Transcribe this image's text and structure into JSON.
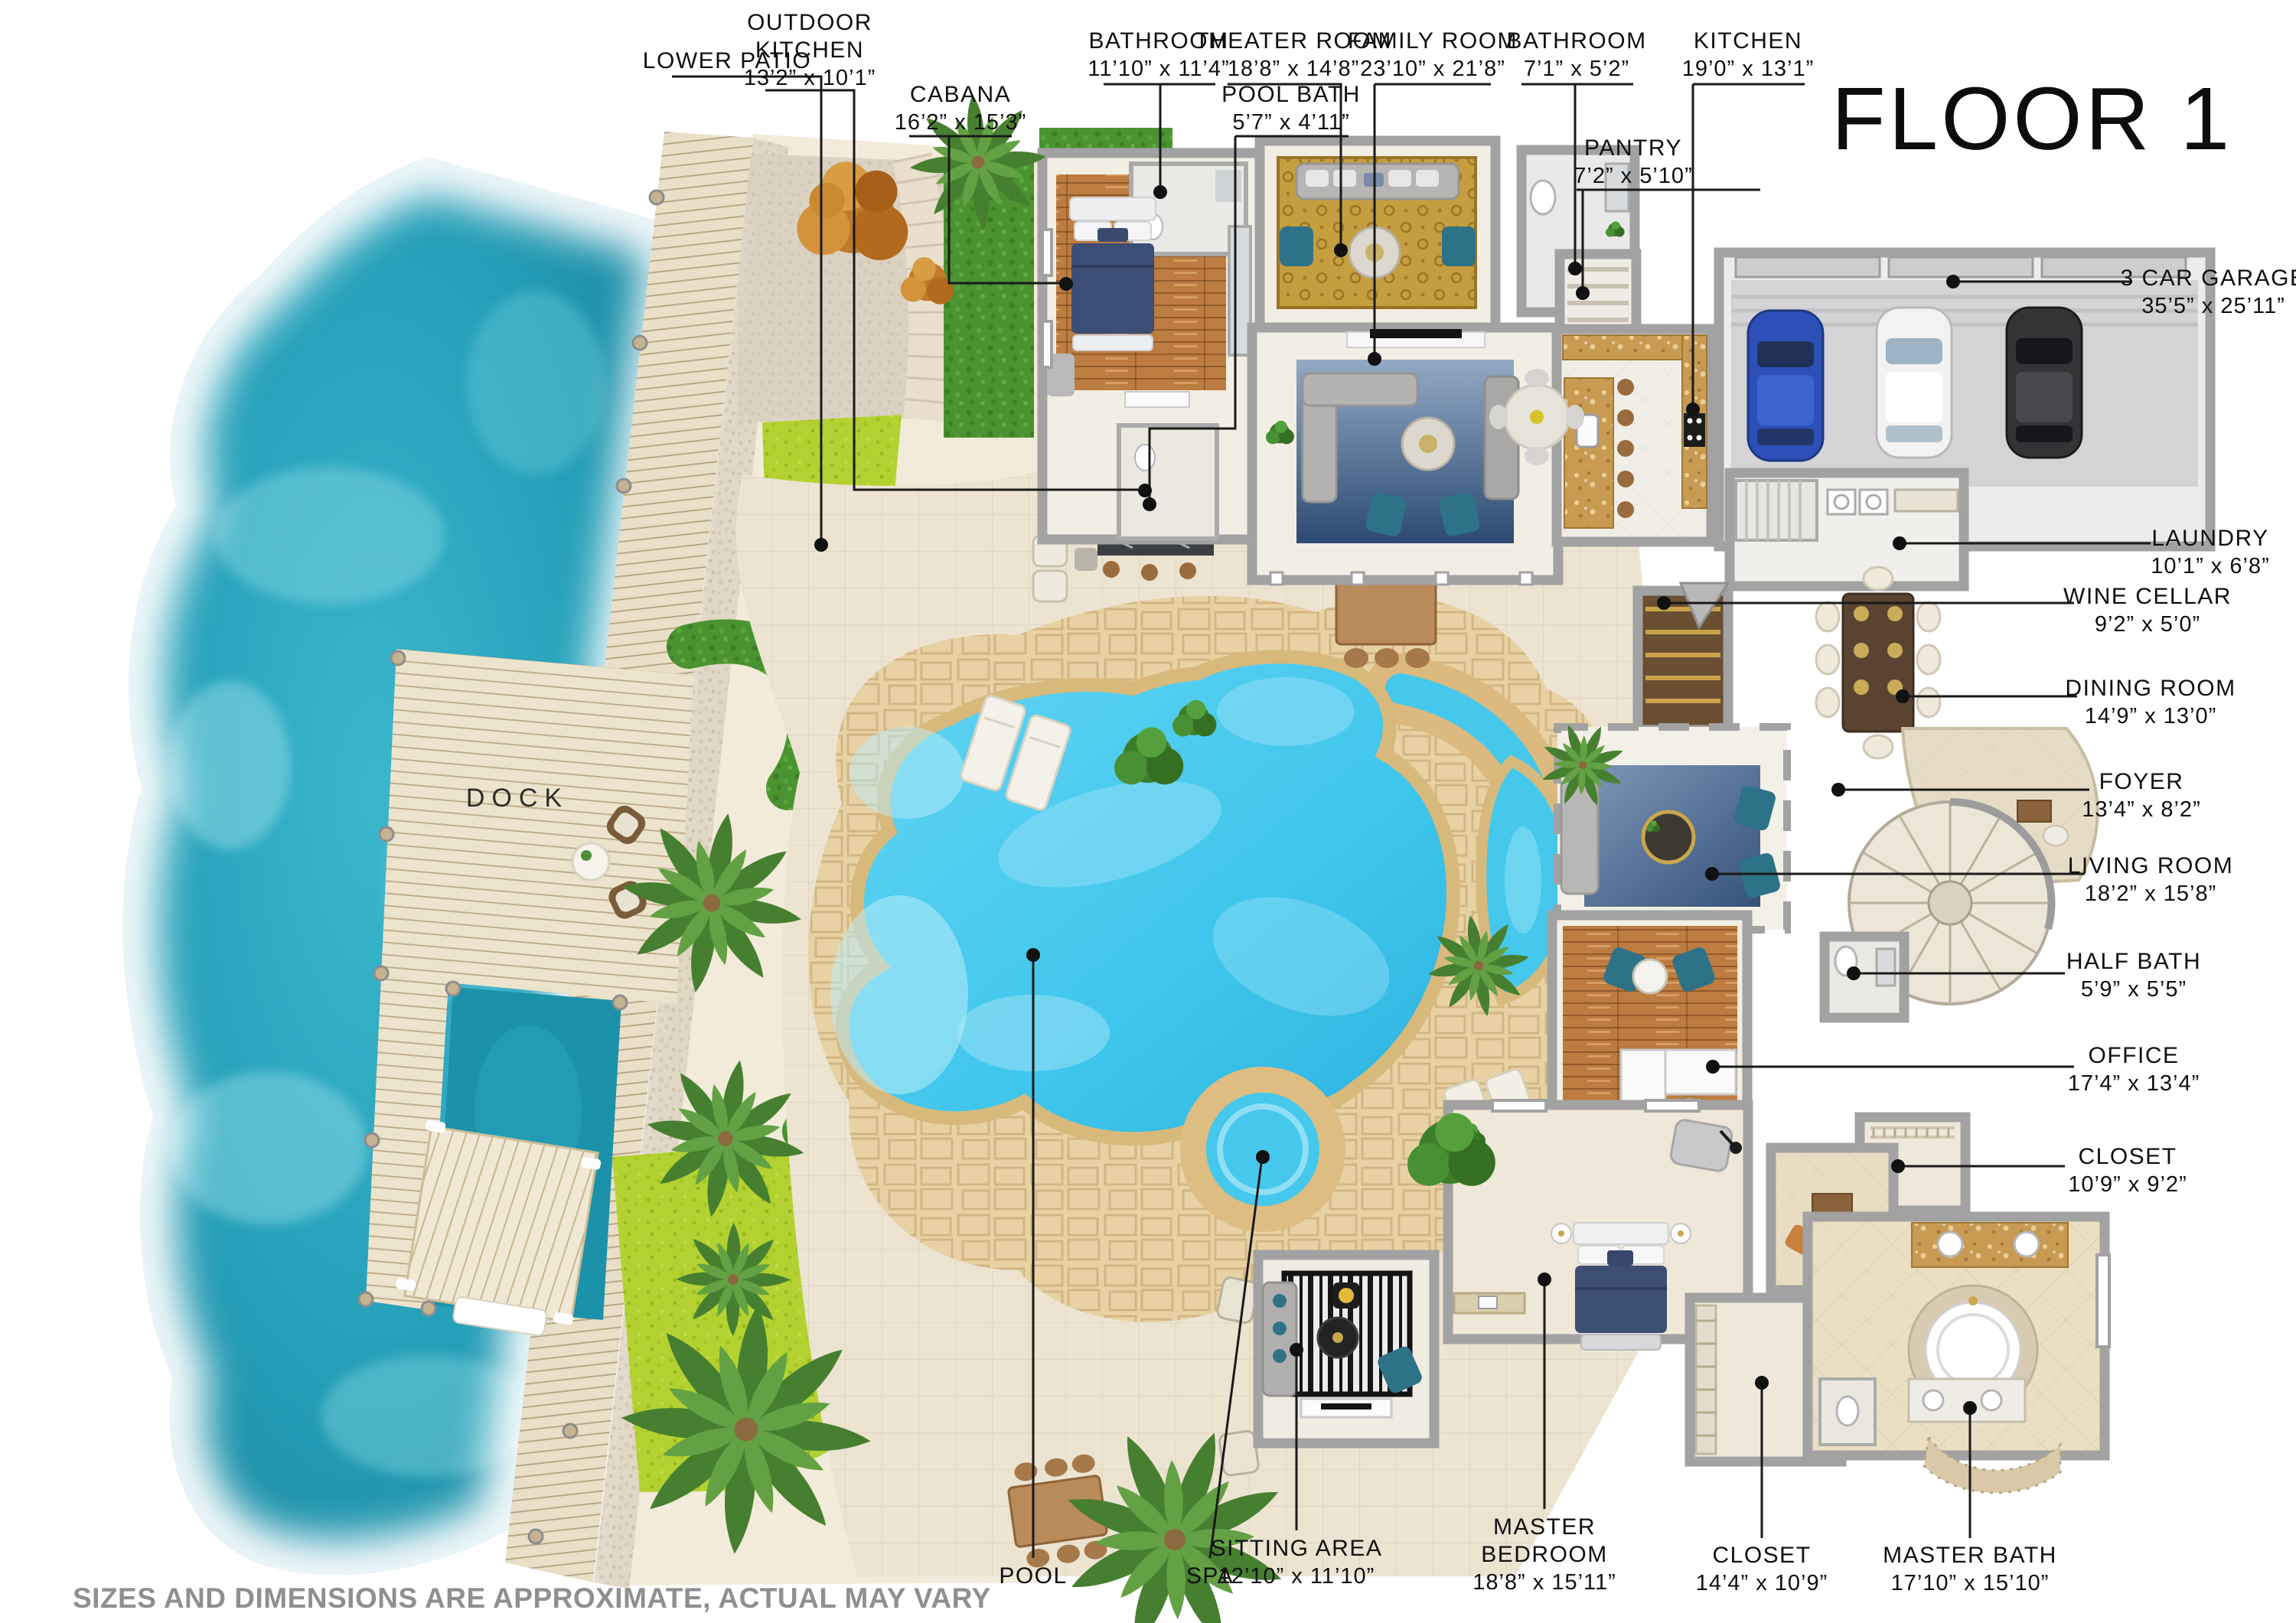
{
  "title": "FLOOR 1",
  "disclaimer": "SIZES AND DIMENSIONS ARE APPROXIMATE, ACTUAL MAY VARY",
  "areas": {
    "dock": "DOCK",
    "pool": "POOL",
    "spa": "SPA"
  },
  "rooms": {
    "lower_patio": {
      "name": "LOWER PATIO",
      "dims": ""
    },
    "outdoor_kitchen": {
      "name": "OUTDOOR KITCHEN",
      "dims": "13’2” x 10’1”"
    },
    "cabana": {
      "name": "CABANA",
      "dims": "16’2” x 15’3”"
    },
    "bathroom_cabana": {
      "name": "BATHROOM",
      "dims": "11’10” x 11’4”"
    },
    "pool_bath": {
      "name": "POOL BATH",
      "dims": "5’7” x 4’11”"
    },
    "theater_room": {
      "name": "THEATER ROOM",
      "dims": "18’8” x 14’8”"
    },
    "family_room": {
      "name": "FAMILY ROOM",
      "dims": "23’10” x 21’8”"
    },
    "bathroom": {
      "name": "BATHROOM",
      "dims": "7’1” x 5’2”"
    },
    "kitchen": {
      "name": "KITCHEN",
      "dims": "19’0” x 13’1”"
    },
    "pantry": {
      "name": "PANTRY",
      "dims": "7’2” x 5’10”"
    },
    "garage": {
      "name": "3 CAR GARAGE",
      "dims": "35’5” x 25’11”"
    },
    "laundry": {
      "name": "LAUNDRY",
      "dims": "10’1” x 6’8”"
    },
    "wine_cellar": {
      "name": "WINE CELLAR",
      "dims": "9’2” x 5’0”"
    },
    "dining_room": {
      "name": "DINING ROOM",
      "dims": "14’9” x 13’0”"
    },
    "foyer": {
      "name": "FOYER",
      "dims": "13’4” x 8’2”"
    },
    "living_room": {
      "name": "LIVING ROOM",
      "dims": "18’2” x 15’8”"
    },
    "half_bath": {
      "name": "HALF BATH",
      "dims": "5’9” x 5’5”"
    },
    "office": {
      "name": "OFFICE",
      "dims": "17’4” x 13’4”"
    },
    "closet": {
      "name": "CLOSET",
      "dims": "10’9” x 9’2”"
    },
    "sitting_area": {
      "name": "SITTING AREA",
      "dims": "12’10” x 11’10”"
    },
    "master_bedroom": {
      "name": "MASTER BEDROOM",
      "dims": "18’8” x 15’11”"
    },
    "master_closet": {
      "name": "CLOSET",
      "dims": "14’4” x 10’9”"
    },
    "master_bath": {
      "name": "MASTER BATH",
      "dims": "17’10” x 15’10”"
    }
  },
  "palette": {
    "water": "#1f9fb6",
    "pool": "#3fc6ec",
    "stone_coping": "#d8b97c",
    "flagstone": "#e8d2a4",
    "sand": "#f3ebd9",
    "lawn": "#b3d231",
    "hedge": "#4a9330",
    "wood_floor": "#b5743a",
    "wall_gray": "#a0a0a0",
    "leader": "#1a1a1a",
    "car_blue": "#2c50b8",
    "car_white": "#f2f2f2",
    "car_black": "#333436",
    "disclaimer_gray": "#8f8f8f"
  }
}
